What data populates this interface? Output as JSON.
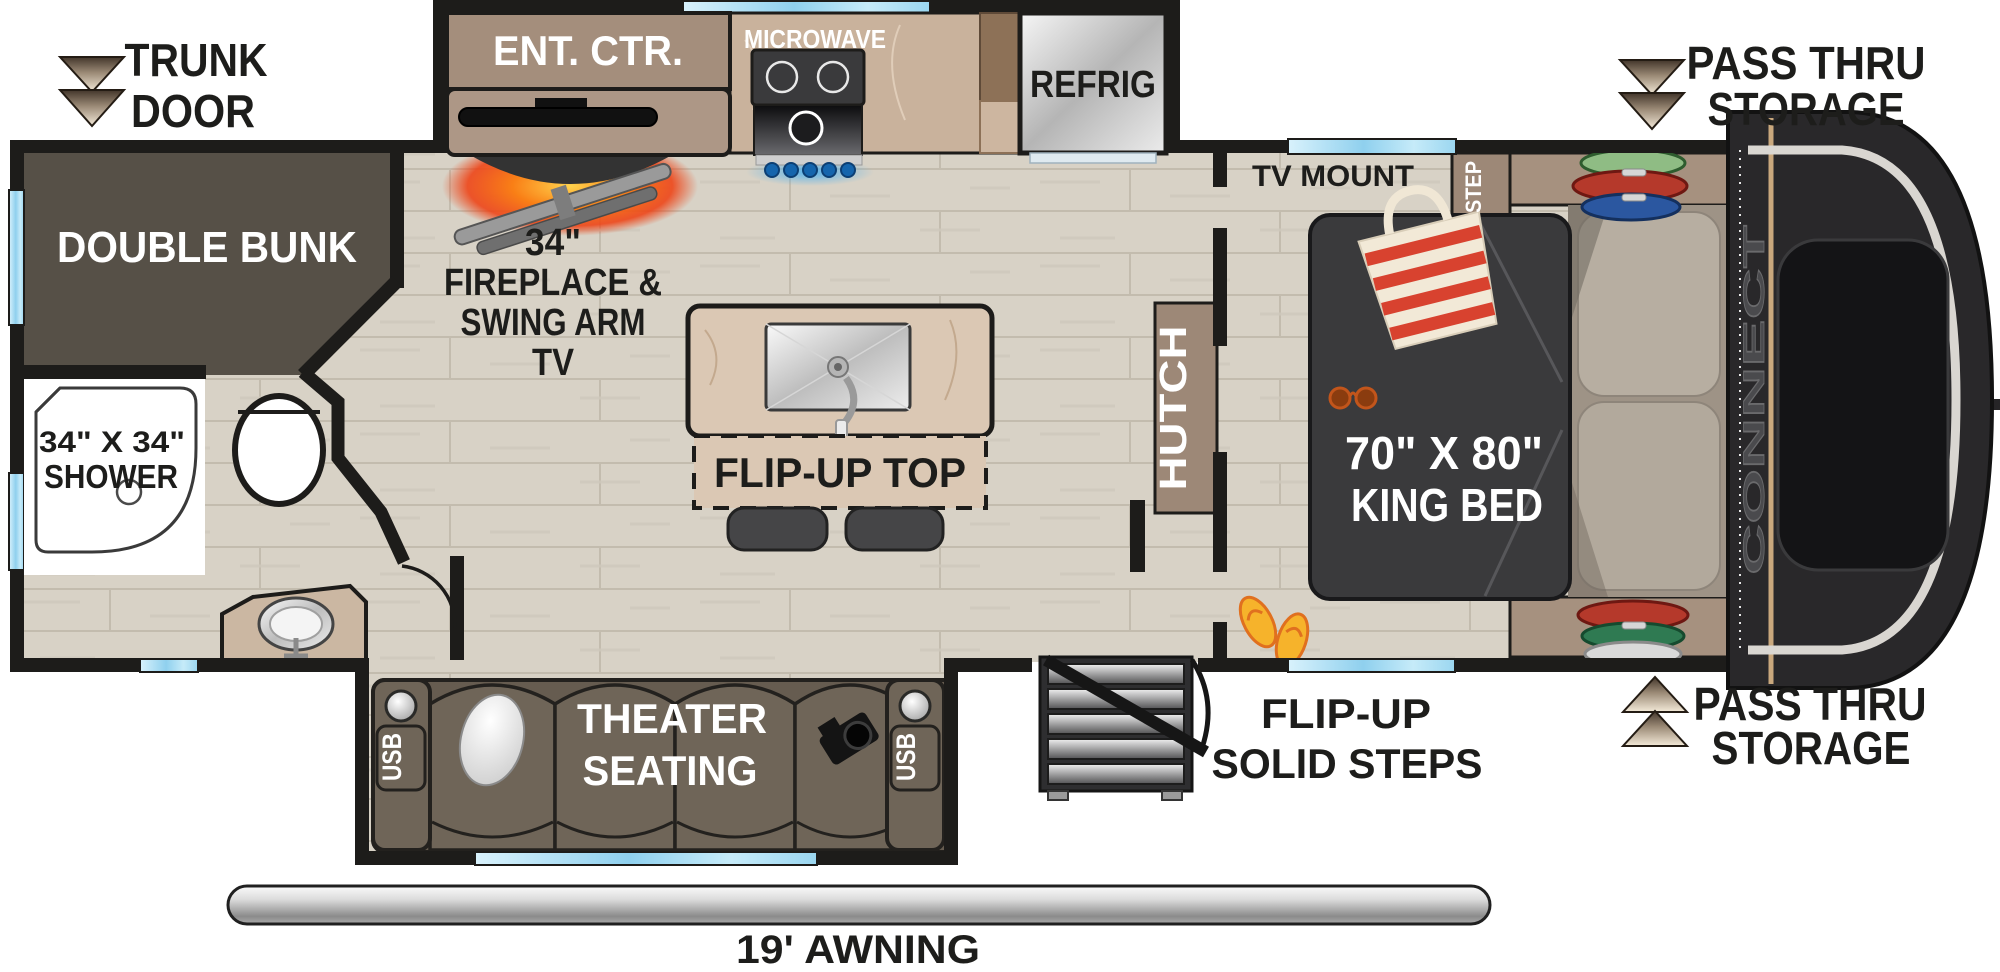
{
  "plan": {
    "brand": "CONNECT"
  },
  "exterior": {
    "trunk_door": {
      "line1": "TRUNK",
      "line2": "DOOR"
    },
    "pass_thru": {
      "line1": "PASS THRU",
      "line2": "STORAGE"
    },
    "awning": "19' AWNING",
    "entry_steps": {
      "line1": "FLIP-UP",
      "line2": "SOLID STEPS"
    }
  },
  "kitchen": {
    "ent_ctr": "ENT. CTR.",
    "microwave": "MICROWAVE",
    "refrig": "REFRIG",
    "fireplace": {
      "line1": "34\"",
      "line2": "FIREPLACE &",
      "line3": "SWING ARM",
      "line4": "TV"
    },
    "island": "FLIP-UP TOP"
  },
  "bunk_room": {
    "label": "DOUBLE BUNK"
  },
  "bathroom": {
    "shower_line1": "34\" X 34\"",
    "shower_line2": "SHOWER"
  },
  "living": {
    "theater_line1": "THEATER",
    "theater_line2": "SEATING",
    "usb": "USB"
  },
  "bedroom": {
    "tv_mount": "TV MOUNT",
    "step": "STEP",
    "hutch": "HUTCH",
    "bed_line1": "70\" X 80\"",
    "bed_line2": "KING BED"
  },
  "colors": {
    "wall": "#1d1c1a",
    "floor": "#d8d2c6",
    "window_blue": "#8fd0ee",
    "bunk": "#565047",
    "sofa": "#6f6558",
    "bed": "#3a3a3c",
    "counter": "#c9b29c",
    "island": "#dbc8b4",
    "cabinet_brown": "#a48e7c",
    "shelf_brown": "#a6917f",
    "fire_glow": "#f97f16",
    "knob_blue": "#1f78c0",
    "awning_silver": "#b9b9b9",
    "arrow_tan": "#f4ead9"
  }
}
